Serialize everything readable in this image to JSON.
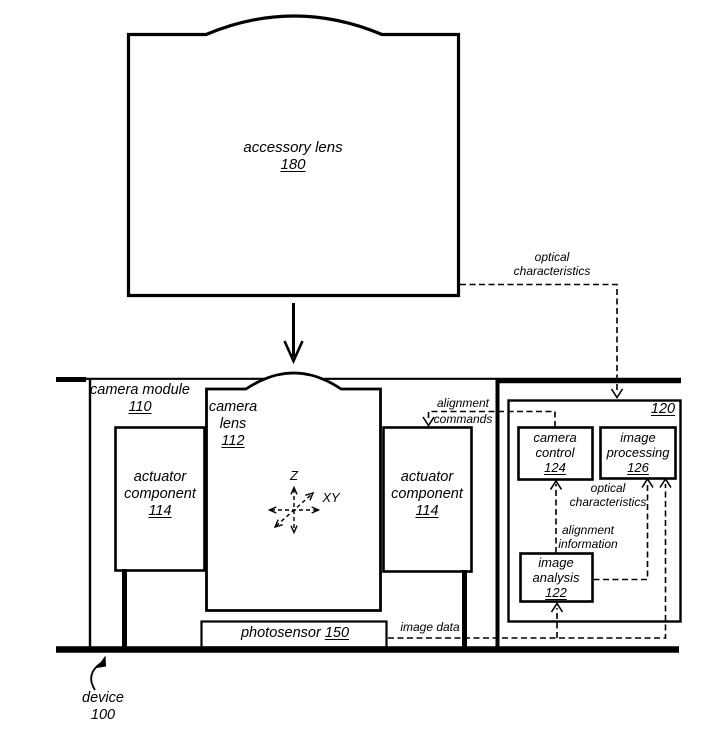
{
  "figure": {
    "boxes": {
      "accessory_lens": {
        "name": "accessory lens",
        "ref": "180"
      },
      "camera_module": {
        "name": "camera module",
        "ref": "110"
      },
      "camera_lens": {
        "line1": "camera",
        "line2": "lens",
        "ref": "112"
      },
      "actuator_left": {
        "line1": "actuator",
        "line2": "component",
        "ref": "114"
      },
      "actuator_right": {
        "line1": "actuator",
        "line2": "component",
        "ref": "114"
      },
      "photosensor": {
        "name": "photosensor",
        "ref": "150"
      },
      "controller": {
        "ref": "120"
      },
      "camera_control": {
        "line1": "camera",
        "line2": "control",
        "ref": "124"
      },
      "image_processing": {
        "line1": "image",
        "line2": "processing",
        "ref": "126"
      },
      "image_analysis": {
        "line1": "image",
        "line2": "analysis",
        "ref": "122"
      },
      "device": {
        "name": "device",
        "ref": "100"
      }
    },
    "flow_labels": {
      "optical_characteristics_top": {
        "line1": "optical",
        "line2": "characteristics"
      },
      "alignment_commands": {
        "line1": "alignment",
        "line2": "commands"
      },
      "optical_characteristics_inner": {
        "line1": "optical",
        "line2": "characteristics"
      },
      "alignment_information": {
        "line1": "alignment",
        "line2": "information"
      },
      "image_data": {
        "line1": "image data"
      }
    },
    "axis": {
      "z": "Z",
      "xy": "XY"
    },
    "colors": {
      "line": "#000000",
      "background": "#ffffff"
    }
  }
}
